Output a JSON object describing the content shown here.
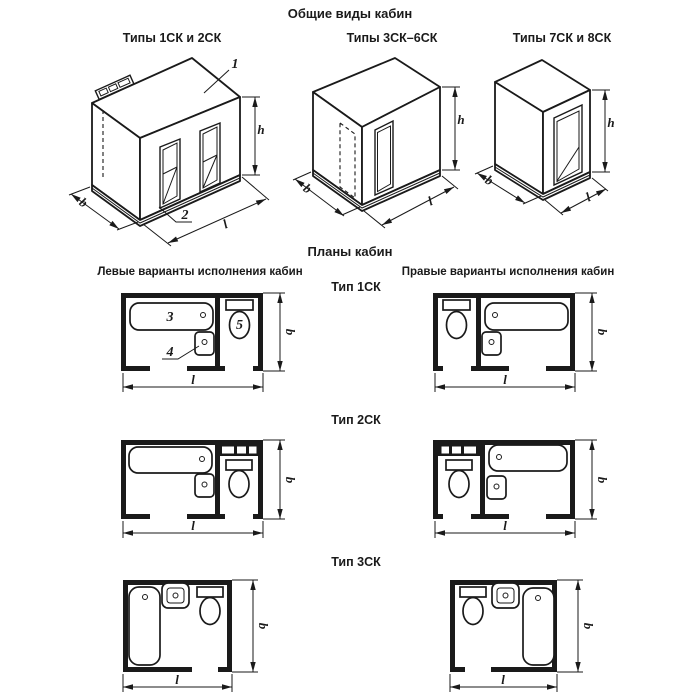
{
  "page": {
    "title": "Общие виды кабин",
    "plans_title": "Планы кабин"
  },
  "general_views": {
    "captions": [
      "Типы 1СК и 2СК",
      "Типы 3СК–6СК",
      "Типы 7СК и 8СК"
    ],
    "callouts": {
      "ceiling_panel": "1",
      "floor_panel": "2"
    },
    "dims": {
      "width": "b",
      "length": "l",
      "height": "h"
    }
  },
  "plans": {
    "left_header": "Левые варианты исполнения кабин",
    "right_header": "Правые варианты исполнения кабин",
    "types": [
      "Тип 1СК",
      "Тип 2СК",
      "Тип 3СК"
    ],
    "callouts": {
      "bath": "3",
      "washbasin": "4",
      "toilet": "5"
    },
    "dims": {
      "width": "b",
      "length": "l"
    }
  }
}
